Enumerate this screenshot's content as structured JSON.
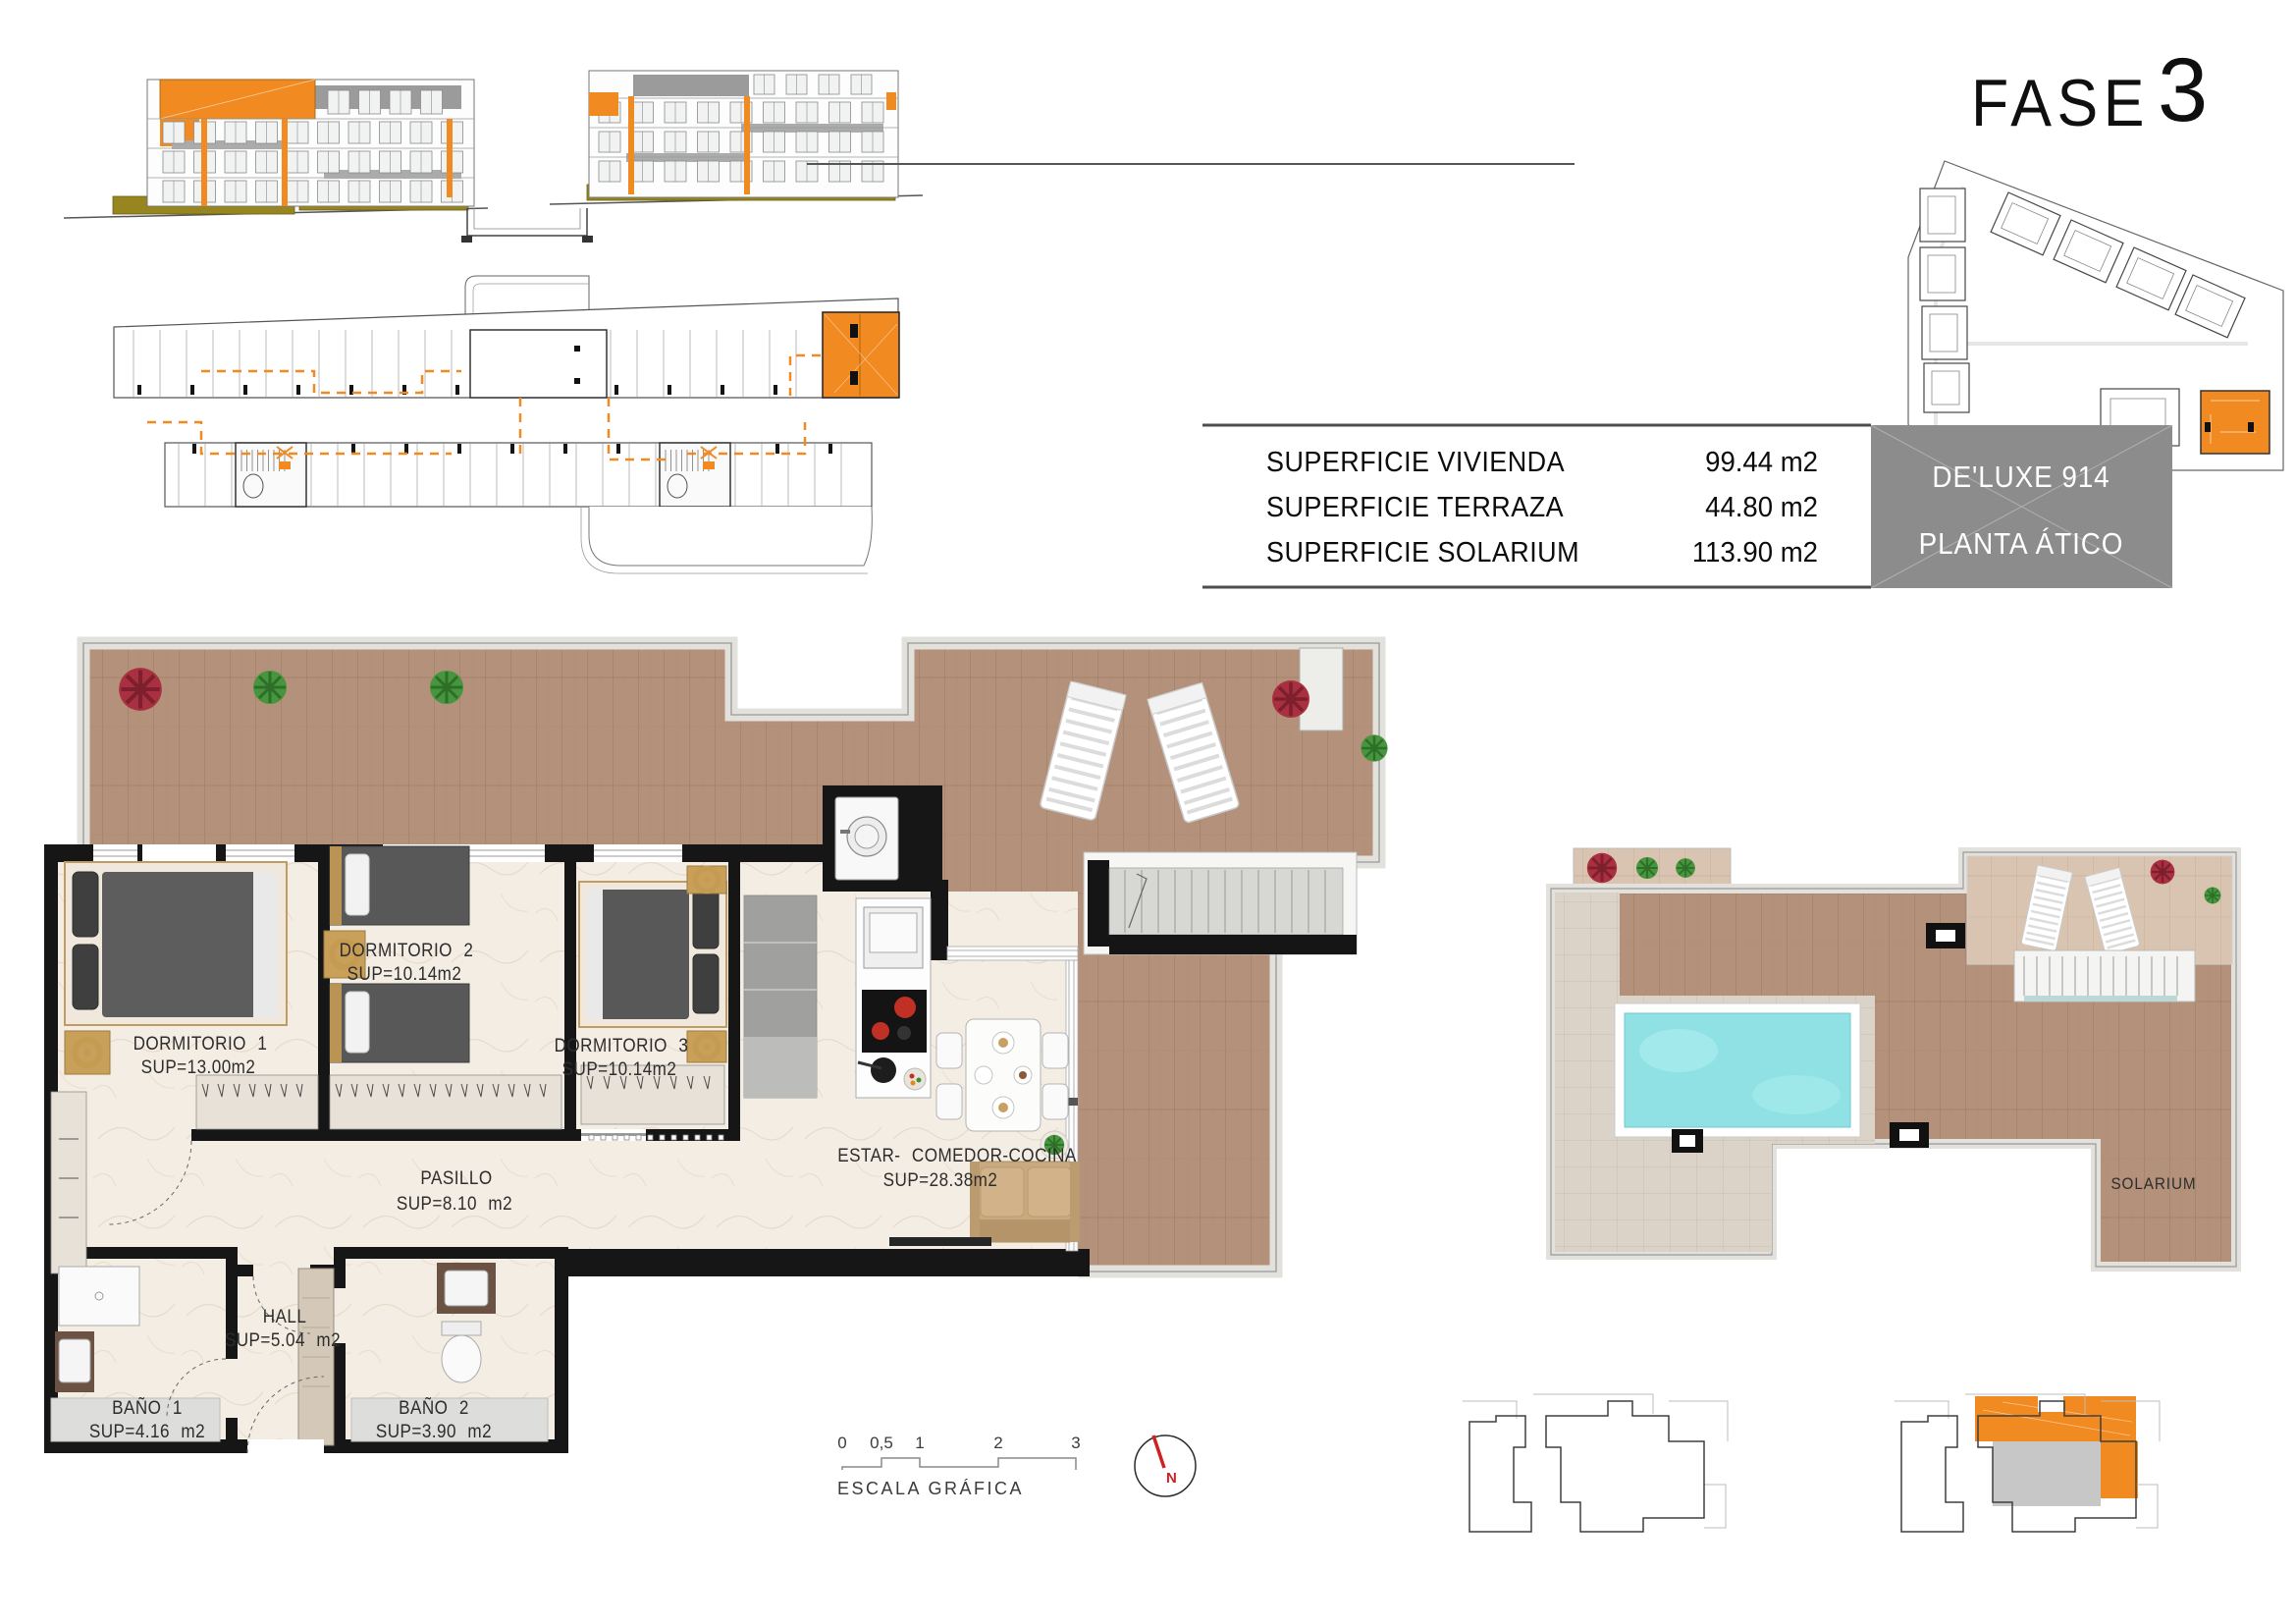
{
  "title": {
    "phase_label": "FASE",
    "phase_number": "3"
  },
  "summary_table": {
    "rows": [
      {
        "label": "SUPERFICIE VIVIENDA",
        "value": "99.44 m2"
      },
      {
        "label": "SUPERFICIE TERRAZA",
        "value": "44.80 m2"
      },
      {
        "label": "SUPERFICIE SOLARIUM",
        "value": "113.90 m2"
      }
    ]
  },
  "unit_badge": {
    "line1": "DE'LUXE 914",
    "line2": "PLANTA ÁTICO"
  },
  "floor_plan": {
    "rooms": [
      {
        "name": "DORMITORIO 1",
        "area": "SUP=13.00m2"
      },
      {
        "name": "DORMITORIO 2",
        "area": "SUP=10.14m2"
      },
      {
        "name": "DORMITORIO 3",
        "area": "SUP=10.14m2"
      },
      {
        "name": "PASILLO",
        "area": "SUP=8.10 m2"
      },
      {
        "name": "HALL",
        "area": "SUP=5.04 m2"
      },
      {
        "name": "BAÑO 1",
        "area": "SUP=4.16 m2"
      },
      {
        "name": "BAÑO 2",
        "area": "SUP=3.90 m2"
      },
      {
        "name": "ESTAR- COMEDOR-COCINA",
        "area": "SUP=28.38m2"
      }
    ]
  },
  "solarium": {
    "label": "SOLARIUM"
  },
  "scale_bar": {
    "ticks": [
      "0",
      "0,5",
      "1",
      "2",
      "3"
    ],
    "caption": "ESCALA GRÁFICA"
  },
  "compass": {
    "north": "N"
  },
  "colors": {
    "accent_orange": "#f18a21",
    "badge_gray": "#8c8c8c",
    "pool_cyan": "#8fe1e3",
    "deck_wood": "#b4917a",
    "deck_wood_light": "#d9c4b1",
    "tile": "#dcd3c8",
    "marble_floor": "#f4ede3",
    "north_red": "#cf2121"
  }
}
